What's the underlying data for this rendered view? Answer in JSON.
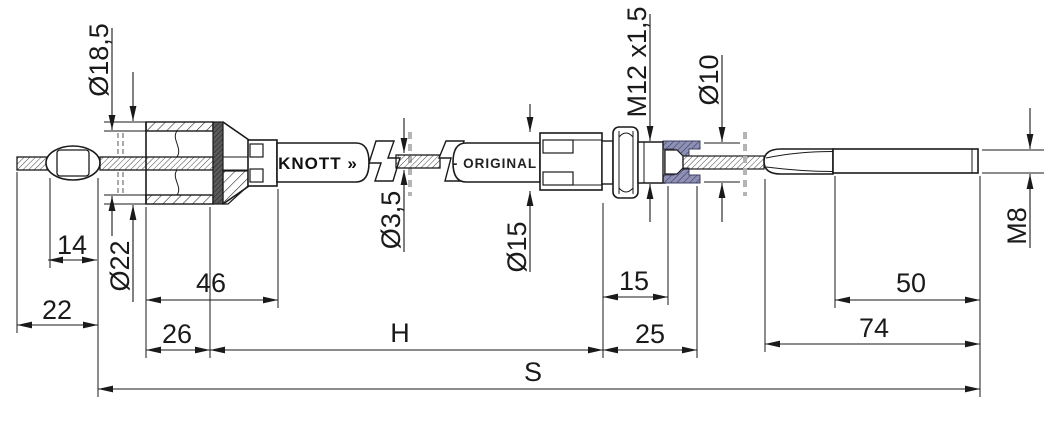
{
  "part_labels": {
    "brand": "KNOTT »",
    "original": "- ORIGINAL -"
  },
  "diameter_labels": {
    "d18_5": "Ø18,5",
    "d22": "Ø22",
    "d3_5": "Ø3,5",
    "d15": "Ø15",
    "d10": "Ø10"
  },
  "thread_labels": {
    "m12": "M12 x1,5",
    "m8": "M8"
  },
  "length_dims": {
    "n14": "14",
    "n22": "22",
    "n46": "46",
    "n26": "26",
    "h": "H",
    "n15": "15",
    "n25": "25",
    "n50": "50",
    "n74": "74",
    "s": "S"
  },
  "colors": {
    "line": "#1a1a1a",
    "socket_fill": "#8e90b4",
    "socket_hatch": "#3c3f63",
    "break_mark": "#b4b4b4",
    "dark_insert": "#555555"
  }
}
